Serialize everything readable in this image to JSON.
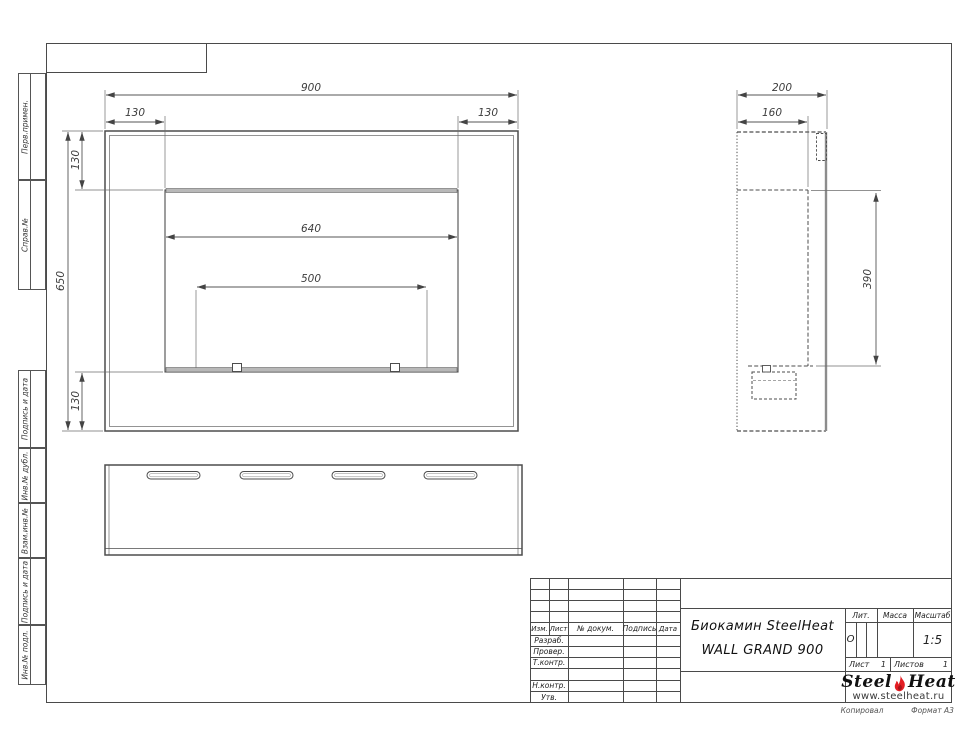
{
  "side_labels": [
    "Перв.примен.",
    "Справ.№",
    "Подпись и дата",
    "Инв.№ дубл.",
    "Взам.инв.№",
    "Подпись и дата",
    "Инв.№ подл."
  ],
  "dimensions": {
    "front": {
      "total_width": "900",
      "left_inset": "130",
      "right_inset": "130",
      "total_height": "650",
      "top_inset": "130",
      "bottom_inset": "130",
      "opening_width": "640",
      "burner_width": "500"
    },
    "side": {
      "depth": "200",
      "inner_depth": "160",
      "mount_height": "390"
    }
  },
  "title_block": {
    "col_izm": "Изм.",
    "col_list": "Лист",
    "col_doc": "№ докум.",
    "col_sign": "Подпись",
    "col_date": "Дата",
    "row_razrab": "Разраб.",
    "row_prover": "Провер.",
    "row_tkontr": "Т.контр.",
    "row_nkontr": "Н.контр.",
    "row_utv": "Утв.",
    "title_line1": "Биокамин SteelHeat",
    "title_line2": "WALL GRAND 900",
    "lit_label": "Лит.",
    "lit_value": "О",
    "massa_label": "Масса",
    "scale_label": "Масштаб",
    "scale_value": "1:5",
    "sheet_label": "Лист",
    "sheet_value": "1",
    "sheets_label": "Листов",
    "sheets_value": "1"
  },
  "logo": {
    "name_part1": "Steel",
    "name_part2": "Heat",
    "website": "www.steelheat.ru",
    "flame_color": "#e31e24"
  },
  "footer": {
    "copied": "Копировал",
    "format": "Формат А3"
  }
}
